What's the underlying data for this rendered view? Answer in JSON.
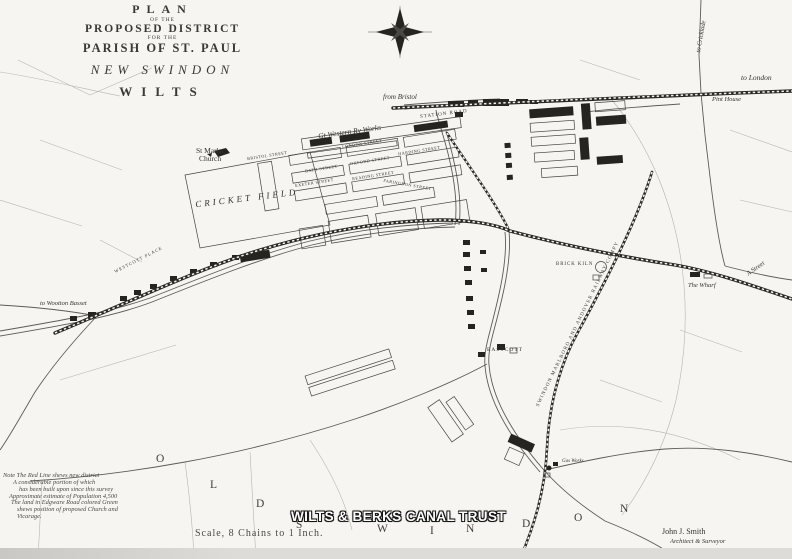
{
  "title": {
    "l1": "PLAN",
    "l2": "OF THE",
    "l3": "PROPOSED DISTRICT",
    "l4": "FOR THE",
    "l5": "PARISH OF ST. PAUL",
    "l6": "NEW SWINDON",
    "l7": "WILTS"
  },
  "labels": {
    "from_bristol": "from Bristol",
    "to_london": "to London",
    "to_cricklade": "to Cricklade",
    "pint_house": "Pint House",
    "to_wootton_bassett": "to Wootton Basset",
    "a_street": "A Street",
    "the_wharf": "The Wharf",
    "st_marks_1": "St Marks",
    "st_marks_2": "Church",
    "gw_works": "Gt Western Ry Works",
    "station_road": "STATION ROAD",
    "bristol_street": "BRISTOL STREET",
    "london_street": "LONDON STREET",
    "bath_street": "BATH STREET",
    "oxford_street": "OXFORD STREET",
    "exeter_street": "EXETER STREET",
    "reading_street": "READING STREET",
    "faringdon_street": "FARINGDON STREET",
    "harding_street": "HARDING STREET",
    "cricket_field": "CRICKET FIELD",
    "westcott_place": "WESTCOTT PLACE",
    "brick_kiln": "BRICK KILN",
    "eastcott": "EASTCOTT",
    "mna_railway": "SWINDON MARLBORO AND ANDOVER RAILWAY COMPY",
    "gas_works": "Gas Works"
  },
  "area_letters": [
    "O",
    "L",
    "D",
    "S",
    "W",
    "I",
    "N",
    "D",
    "O",
    "N"
  ],
  "note": {
    "lines": [
      "Note  The Red Line shews new district",
      "A considerable portion of which",
      "has been built upon since this survey",
      "Approximate estimate of Population 4,500",
      "The land in Edgware Road colored Green",
      "shews position of proposed Church and",
      "Vicarage."
    ]
  },
  "watermark": "WILTS & BERKS CANAL TRUST",
  "scale_text": "Scale, 8  Chains to 1 Inch.",
  "credit": {
    "name": "John J. Smith",
    "role": "Architect & Surveyor"
  },
  "icons": {
    "compass": "compass-rose",
    "church": "church-symbol",
    "brick_kiln": "kiln-circle",
    "gas_works": "gas-works-symbol"
  },
  "colors": {
    "ink": "#2b2924",
    "paper": "#f6f5f1"
  }
}
